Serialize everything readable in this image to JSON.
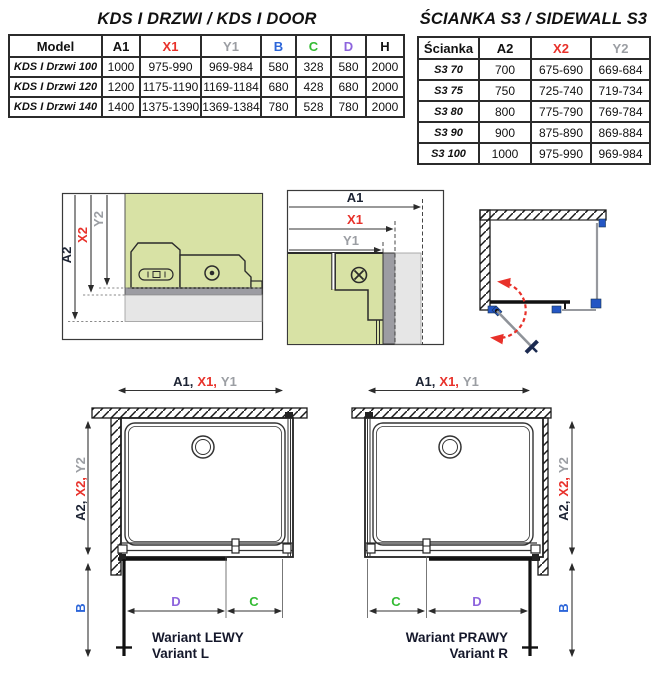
{
  "door_table": {
    "title": "KDS I DRZWI / KDS I DOOR",
    "columns": [
      {
        "label": "Model",
        "color": "#111111"
      },
      {
        "label": "A1",
        "color": "#111111"
      },
      {
        "label": "X1",
        "color": "#e8312a"
      },
      {
        "label": "Y1",
        "color": "#9b9ea3"
      },
      {
        "label": "B",
        "color": "#2b65d9"
      },
      {
        "label": "C",
        "color": "#33bb33"
      },
      {
        "label": "D",
        "color": "#8d64dd"
      },
      {
        "label": "H",
        "color": "#111111"
      }
    ],
    "rows": [
      [
        "KDS I Drzwi 100",
        "1000",
        "975-990",
        "969-984",
        "580",
        "328",
        "580",
        "2000"
      ],
      [
        "KDS I Drzwi 120",
        "1200",
        "1175-1190",
        "1169-1184",
        "680",
        "428",
        "680",
        "2000"
      ],
      [
        "KDS I Drzwi 140",
        "1400",
        "1375-1390",
        "1369-1384",
        "780",
        "528",
        "780",
        "2000"
      ]
    ]
  },
  "sidewall_table": {
    "title": "ŚCIANKA S3 / SIDEWALL S3",
    "columns": [
      {
        "label": "Ścianka",
        "color": "#111111"
      },
      {
        "label": "A2",
        "color": "#111111"
      },
      {
        "label": "X2",
        "color": "#e8312a"
      },
      {
        "label": "Y2",
        "color": "#9b9ea3"
      }
    ],
    "rows": [
      [
        "S3 70",
        "700",
        "675-690",
        "669-684"
      ],
      [
        "S3 75",
        "750",
        "725-740",
        "719-734"
      ],
      [
        "S3 80",
        "800",
        "775-790",
        "769-784"
      ],
      [
        "S3 90",
        "900",
        "875-890",
        "869-884"
      ],
      [
        "S3 100",
        "1000",
        "975-990",
        "969-984"
      ]
    ]
  },
  "dims": {
    "a1": "A1",
    "x1": "X1",
    "y1": "Y1",
    "a2": "A2",
    "x2": "X2",
    "y2": "Y2",
    "a1_c": "A1,",
    "x1_c": "X1,",
    "y1_p": "Y1",
    "a2_c": "A2,",
    "x2_c": "X2,",
    "y2_p": "Y2",
    "b": "B",
    "c": "C",
    "d": "D"
  },
  "variants": {
    "left": {
      "line1": "Wariant LEWY",
      "line2": "Variant L"
    },
    "right": {
      "line1": "Wariant PRAWY",
      "line2": "Variant R"
    }
  },
  "colors": {
    "accent_red": "#e8312a",
    "dim_gray": "#9b9ea3",
    "blue": "#2b65d9",
    "green": "#33bb33",
    "purple": "#8d64dd",
    "text": "#111111",
    "glass_green": "#d8e2a5",
    "profile_gray": "#9c9ca2",
    "slab_gray": "#e6e6e6",
    "hardware_blue": "#2456c4"
  }
}
